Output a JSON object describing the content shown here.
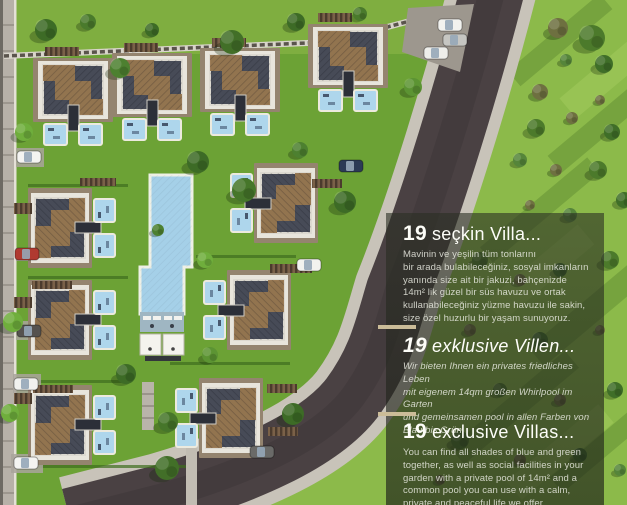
{
  "panel": {
    "sections": [
      {
        "number": "19",
        "title": "seçkin Villa...",
        "body": "Mavinin ve yeşilin tüm tonlarını\nbir arada bulabileceğiniz, sosyal imkanların\nyanında size ait bir jakuzi, bahçenizde\n14m² lik güzel bir süs havuzu ve ortak\nkullanabileceğiniz yüzme havuzu ile sakin,\nsize özel huzurlu bir yaşam sunuyoruz."
      },
      {
        "number": "19",
        "title": "exklusive Villen...",
        "body": "Wir bieten Ihnen ein privates friedliches Leben\nmit eigenem 14qm großen Whirlpool im Garten\nund gemeinsamen pool in allen Farben von\nBlau bis Grün."
      },
      {
        "number": "19",
        "title": "exclusive Villas...",
        "body": "You can find all shades of blue and green\ntogether, as well as social facilities in your\ngarden with a private pool of 14m² and a\ncommon pool you can use with a calm,\nprivate and peaceful life we offer."
      }
    ]
  },
  "colors": {
    "panel_bg": "rgba(32,36,27,0.62)",
    "divider_tan": "#cbbc98",
    "site_grass": "#6ca235",
    "field_grass": "#8cba4a",
    "asphalt": "#4a4143",
    "sidewalk": "#c8c3b9",
    "pool_blue": "#a5d0e8",
    "roof_dark": "#474b57",
    "roof_brown": "#97764f",
    "villa_wall": "#94846f",
    "deck_white": "#e8e5dc"
  }
}
